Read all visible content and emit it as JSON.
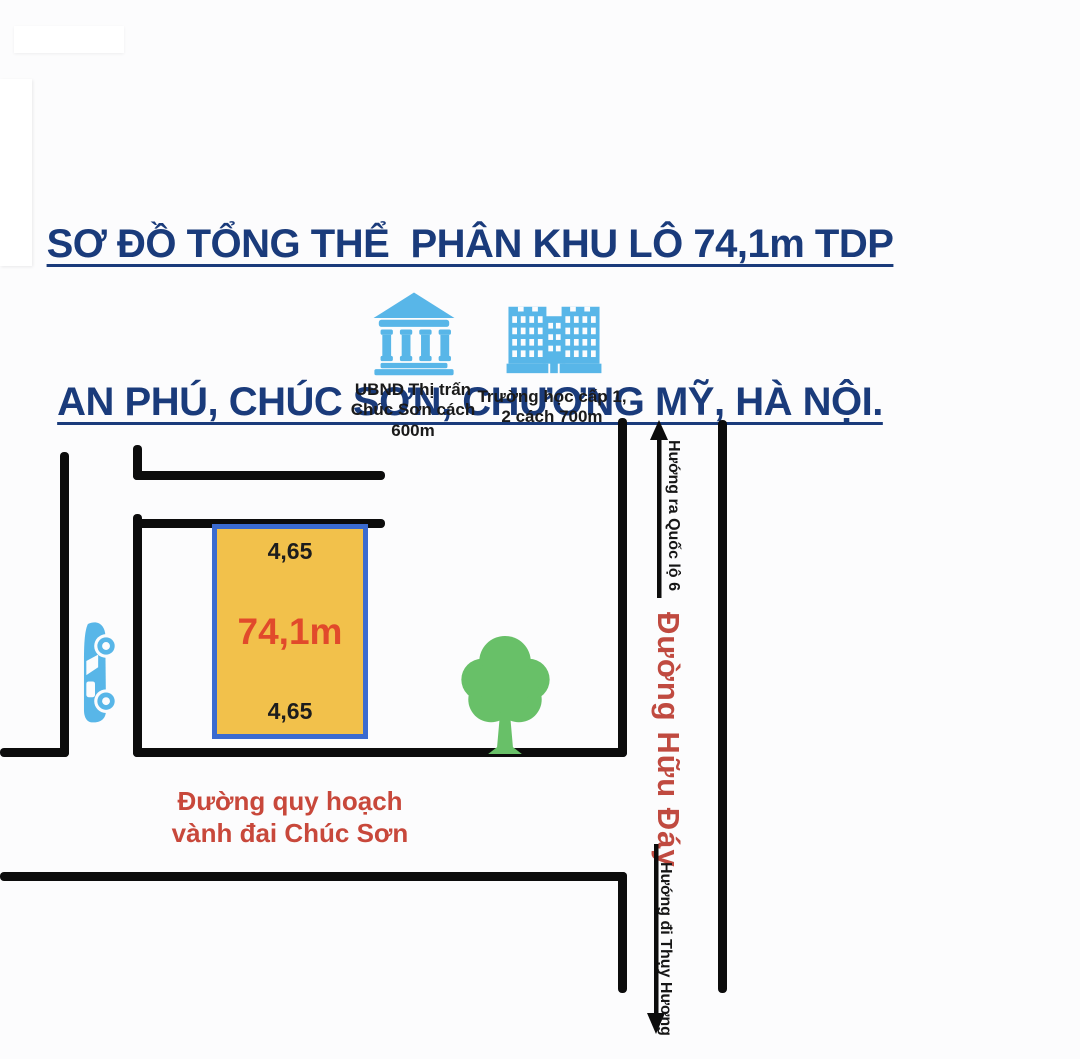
{
  "title": {
    "line1": "SƠ ĐỒ TỔNG THỂ  PHÂN KHU LÔ 74,1m TDP",
    "line2": "AN PHÚ, CHÚC SƠN, CHƯƠNG MỸ, HÀ NỘI.",
    "color": "#1a3b7b"
  },
  "landmarks": {
    "ubnd": {
      "icon": "government-building-icon",
      "lines": [
        "UBND Thị trấn",
        "Chúc Sơn cách",
        "600m"
      ]
    },
    "school": {
      "icon": "school-building-icon",
      "lines": [
        "Trường học cấp 1,",
        "2 cách 700m"
      ]
    },
    "icon_color": "#58b6e8"
  },
  "plot": {
    "top_width": "4,65",
    "area_label": "74,1m",
    "bottom_width": "4,65",
    "fill_color": "#f2c14b",
    "border_color": "#3b6bd0",
    "area_text_color": "#e14a2b"
  },
  "roads": {
    "main_road_name": "Đường Hữu Đáy",
    "direction_up": "Hướng ra Quốc lộ 6",
    "direction_down": "Hướng đi Thụy Hương",
    "planned_road": {
      "line1": "Đường quy hoạch",
      "line2": "vành đai Chúc Sơn"
    },
    "road_color": "#0c0c0c",
    "red_label_color": "#c8483b"
  },
  "decorations": {
    "car_icon": "car-icon",
    "tree_icon": "tree-icon",
    "car_color": "#58b6e8",
    "tree_color": "#68c068"
  }
}
